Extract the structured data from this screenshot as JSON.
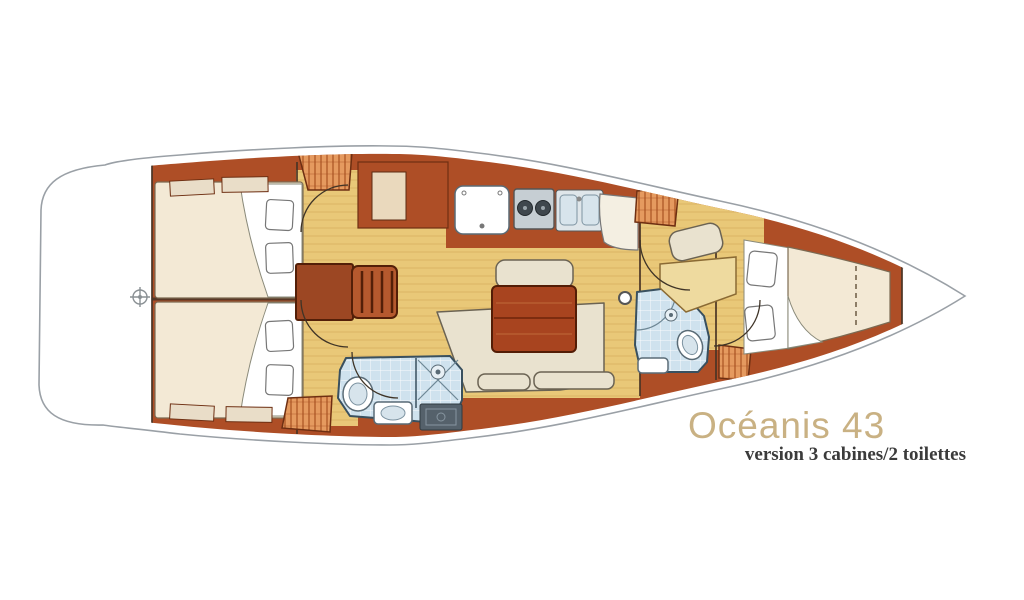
{
  "branding": {
    "model": "Océanis 43",
    "version": "version 3 cabines/2 toilettes"
  },
  "colors": {
    "background": "#ffffff",
    "hull_line": "#9aa0a6",
    "wood_trim": "#ae4e26",
    "wood_dark": "#6e2f12",
    "floor": "#e9c878",
    "floor_grain": "#cfa254",
    "mattress": "#f3e9d5",
    "cushion": "#e9e2cf",
    "tile": "#cfe2ee",
    "locker": "#e59a5f",
    "locker_hatch": "#a34b1c",
    "table": "#a8441f",
    "title": "#c9b183",
    "subtitle": "#3b3b3b"
  }
}
